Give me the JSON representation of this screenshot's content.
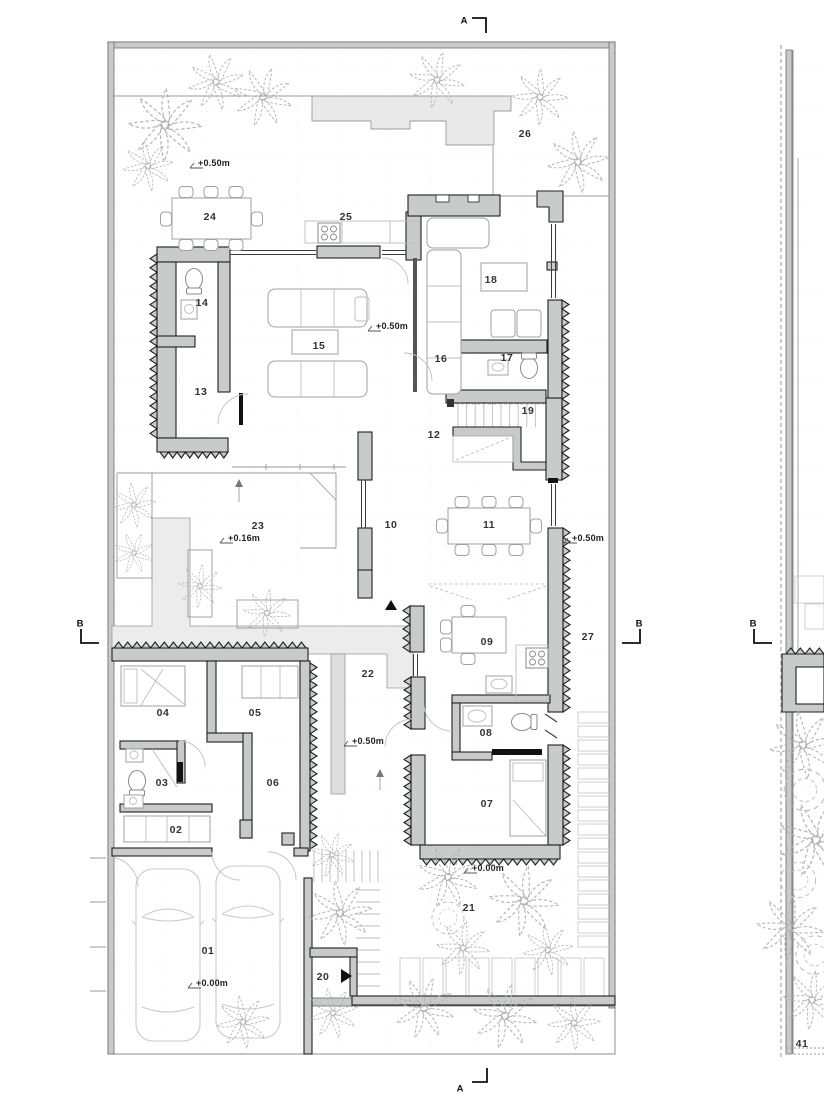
{
  "drawing": {
    "type": "architectural-floor-plan",
    "sheet": "ground-floor-plan",
    "rooms": [
      {
        "id": "01",
        "x": 208,
        "y": 951
      },
      {
        "id": "02",
        "x": 176,
        "y": 830
      },
      {
        "id": "03",
        "x": 162,
        "y": 783
      },
      {
        "id": "04",
        "x": 163,
        "y": 713
      },
      {
        "id": "05",
        "x": 255,
        "y": 713
      },
      {
        "id": "06",
        "x": 273,
        "y": 783
      },
      {
        "id": "07",
        "x": 487,
        "y": 804
      },
      {
        "id": "08",
        "x": 486,
        "y": 733
      },
      {
        "id": "09",
        "x": 487,
        "y": 642
      },
      {
        "id": "10",
        "x": 391,
        "y": 525
      },
      {
        "id": "11",
        "x": 489,
        "y": 525
      },
      {
        "id": "12",
        "x": 434,
        "y": 435
      },
      {
        "id": "13",
        "x": 201,
        "y": 392
      },
      {
        "id": "14",
        "x": 202,
        "y": 303
      },
      {
        "id": "15",
        "x": 319,
        "y": 346
      },
      {
        "id": "16",
        "x": 441,
        "y": 359
      },
      {
        "id": "17",
        "x": 507,
        "y": 358
      },
      {
        "id": "18",
        "x": 491,
        "y": 280
      },
      {
        "id": "19",
        "x": 528,
        "y": 411
      },
      {
        "id": "20",
        "x": 323,
        "y": 977
      },
      {
        "id": "21",
        "x": 469,
        "y": 908
      },
      {
        "id": "22",
        "x": 368,
        "y": 674
      },
      {
        "id": "23",
        "x": 258,
        "y": 526
      },
      {
        "id": "24",
        "x": 210,
        "y": 217
      },
      {
        "id": "25",
        "x": 346,
        "y": 217
      },
      {
        "id": "26",
        "x": 525,
        "y": 134
      },
      {
        "id": "27",
        "x": 588,
        "y": 637
      },
      {
        "id": "41",
        "x": 802,
        "y": 1044
      }
    ],
    "levels": [
      {
        "text": "+0.50m",
        "x": 198,
        "y": 163
      },
      {
        "text": "+0.50m",
        "x": 376,
        "y": 326
      },
      {
        "text": "+0.50m",
        "x": 572,
        "y": 538
      },
      {
        "text": "+0.16m",
        "x": 228,
        "y": 538
      },
      {
        "text": "+0.50m",
        "x": 352,
        "y": 741
      },
      {
        "text": "+0.00m",
        "x": 472,
        "y": 868
      },
      {
        "text": "+0.00m",
        "x": 196,
        "y": 983
      }
    ],
    "sections": [
      {
        "id": "a_top",
        "label": "A",
        "x": 464,
        "y": 21
      },
      {
        "id": "a_bottom",
        "label": "A",
        "x": 460,
        "y": 1089
      },
      {
        "id": "b_left",
        "label": "B",
        "x": 80,
        "y": 624
      },
      {
        "id": "b_right_inner",
        "label": "B",
        "x": 639,
        "y": 624
      },
      {
        "id": "b_right_outer",
        "label": "B",
        "x": 753,
        "y": 624
      }
    ],
    "colors": {
      "wall": "#c9cbcb",
      "wallLine": "#1f1f1f",
      "light": "#ececec",
      "canopy": "#e9e9e9",
      "furniture": "#a0a0a0",
      "plant": "#b3b3b3",
      "border": "#8c8c8c",
      "label": "#333333",
      "accent": "#111111"
    }
  }
}
